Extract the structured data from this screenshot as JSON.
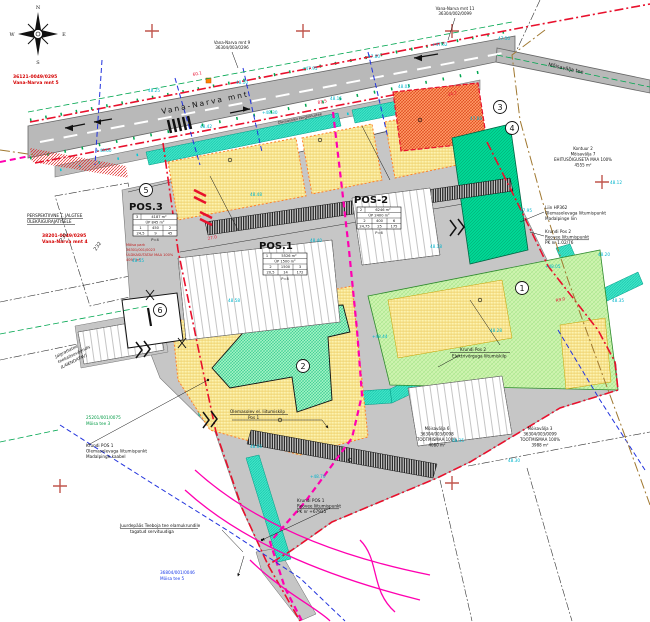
{
  "compass": {
    "n": "N",
    "e": "E",
    "s": "S",
    "w": "W"
  },
  "roads": {
    "main": "Vana-Narva mnt",
    "branch": "Mõisavälja tee",
    "path_note": "Olemasolev kergliiklustee"
  },
  "pos_tables": {
    "pos1": {
      "title": "POS.1",
      "rows": [
        [
          "1",
          "5526 m²"
        ],
        [
          "ÜP 1500 m²"
        ],
        [
          "2",
          "1500",
          "3"
        ],
        [
          "20,5",
          "14",
          "172"
        ]
      ],
      "note": "P=8"
    },
    "pos2": {
      "title": "POS-2",
      "rows": [
        [
          "2",
          "6246 m²"
        ],
        [
          "ÜP 2400 m²"
        ],
        [
          "2",
          "400",
          "6"
        ],
        [
          "24,75",
          "25",
          "175"
        ]
      ],
      "note": "P=6"
    },
    "pos3": {
      "title": "POS.3",
      "rows": [
        [
          "3",
          "4187 m²"
        ],
        [
          "ÜP 845 m²"
        ],
        [
          "1",
          "450",
          "2"
        ],
        [
          "24,5",
          "9",
          "45"
        ]
      ],
      "note": "P=4"
    }
  },
  "circle_labels": [
    "1",
    "2",
    "3",
    "4",
    "5",
    "6"
  ],
  "cadastral": {
    "c1": [
      "36121-0049/0295",
      "Vana-Narva mnt 5"
    ],
    "c2": [
      "38201-0049/0295",
      "Vana-Narva mnt 4"
    ],
    "c3": [
      "Vana-Narva mnt 9",
      "36304/003/0296"
    ],
    "c4": [
      "Vana-Narva mnt 11",
      "36304/002/0099"
    ],
    "c5": [
      "25201/001/0075",
      "Mõisa tee 3"
    ],
    "c6": [
      "36804/001/0046",
      "Mõisa tee 5"
    ],
    "c7": [
      "Mõisavälja 6",
      "36304/003/0098",
      "TOOTMISMAA 100%",
      "4080 m²"
    ],
    "c8": [
      "Mõisavälja 3",
      "36304/003/0099",
      "TOOTMISMAA 100%",
      "3988 m²"
    ],
    "c9": [
      "Kontuur 2",
      "Mõisavälja 7",
      "EHITUSÕIGUSETA MAA 100%",
      "4555 m²"
    ],
    "c10": [
      "Mõisa park",
      "36301/001/0023",
      "ÜLDKASUTATAV MAA 100%",
      "4097 m²"
    ]
  },
  "ann": {
    "persp": [
      "PERSPEKTIIVNE T. JALGTEE",
      "ÜLEKÄIGURAJATISELE"
    ],
    "hp": [
      "Liin HP362",
      "Olemasolevaga liitumispunkt",
      "Madalpinge liin"
    ],
    "reovee2": [
      "Krundi Pos 2",
      "Reovee liitumispunkt",
      "PK nr 1.02/76"
    ],
    "elektri2": [
      "Krundi Pos 2",
      "Elektrivõrguga liitumiskilp"
    ],
    "el1": [
      "Olemasolev el. liitumiskilp",
      "Pos 1"
    ],
    "madalpinge1": [
      "Krundi POS 1",
      "Olemasolevaga liitumispunkt",
      "Madalpinge kaabel"
    ],
    "reovee1": [
      "Krundi POS 1",
      "Reovee liitumispunkt",
      "PK nr +67915"
    ],
    "juurdepaas": [
      "Juurdepääs Teeboja tee elamukrundile",
      "tagatud servituudiga"
    ],
    "jalgratta": [
      "Jalgrattatee",
      "teekaitsevööndis",
      "(LAIENDATAV)"
    ]
  },
  "decorations": {
    "crosses": [
      [
        152,
        31
      ],
      [
        303,
        31
      ],
      [
        452,
        31
      ],
      [
        452,
        182
      ],
      [
        602,
        182
      ],
      [
        60,
        486
      ],
      [
        452,
        483
      ]
    ],
    "elevations": [
      {
        "x": 148,
        "y": 92,
        "t": "48.25"
      },
      {
        "x": 236,
        "y": 84,
        "t": "48.10"
      },
      {
        "x": 302,
        "y": 70,
        "t": "+47.95"
      },
      {
        "x": 368,
        "y": 58,
        "t": "47.80"
      },
      {
        "x": 432,
        "y": 46,
        "t": "+47.62"
      },
      {
        "x": 498,
        "y": 40,
        "t": "47.50"
      },
      {
        "x": 200,
        "y": 128,
        "t": "48.42"
      },
      {
        "x": 262,
        "y": 114,
        "t": "+48.30"
      },
      {
        "x": 330,
        "y": 100,
        "t": "48.15"
      },
      {
        "x": 398,
        "y": 88,
        "t": "48.02"
      },
      {
        "x": 470,
        "y": 120,
        "t": "47.88"
      },
      {
        "x": 520,
        "y": 212,
        "t": "47.95"
      },
      {
        "x": 545,
        "y": 268,
        "t": "+48.05"
      },
      {
        "x": 598,
        "y": 256,
        "t": "48.20"
      },
      {
        "x": 612,
        "y": 302,
        "t": "48.35"
      },
      {
        "x": 132,
        "y": 262,
        "t": "48.55"
      },
      {
        "x": 96,
        "y": 152,
        "t": "+48.60"
      },
      {
        "x": 250,
        "y": 196,
        "t": "48.48"
      },
      {
        "x": 310,
        "y": 242,
        "t": "48.40"
      },
      {
        "x": 430,
        "y": 248,
        "t": "48.18"
      },
      {
        "x": 372,
        "y": 338,
        "t": "+48.44"
      },
      {
        "x": 490,
        "y": 332,
        "t": "48.28"
      },
      {
        "x": 228,
        "y": 302,
        "t": "48.58"
      },
      {
        "x": 250,
        "y": 448,
        "t": "48.66"
      },
      {
        "x": 310,
        "y": 478,
        "t": "+48.70"
      },
      {
        "x": 452,
        "y": 442,
        "t": "48.35"
      },
      {
        "x": 508,
        "y": 462,
        "t": "48.30"
      },
      {
        "x": 610,
        "y": 184,
        "t": "48.12"
      }
    ],
    "dims": [
      {
        "x": 193,
        "y": 76,
        "t": "60.1"
      },
      {
        "x": 318,
        "y": 104,
        "t": "81.5"
      },
      {
        "x": 448,
        "y": 96,
        "t": "34.2"
      },
      {
        "x": 208,
        "y": 240,
        "t": "27.0"
      },
      {
        "x": 556,
        "y": 302,
        "t": "R9.0"
      }
    ],
    "parcel_numbers": [
      {
        "x": 62,
        "y": 242,
        "t": "231"
      },
      {
        "x": 96,
        "y": 251,
        "t": "232"
      }
    ]
  }
}
